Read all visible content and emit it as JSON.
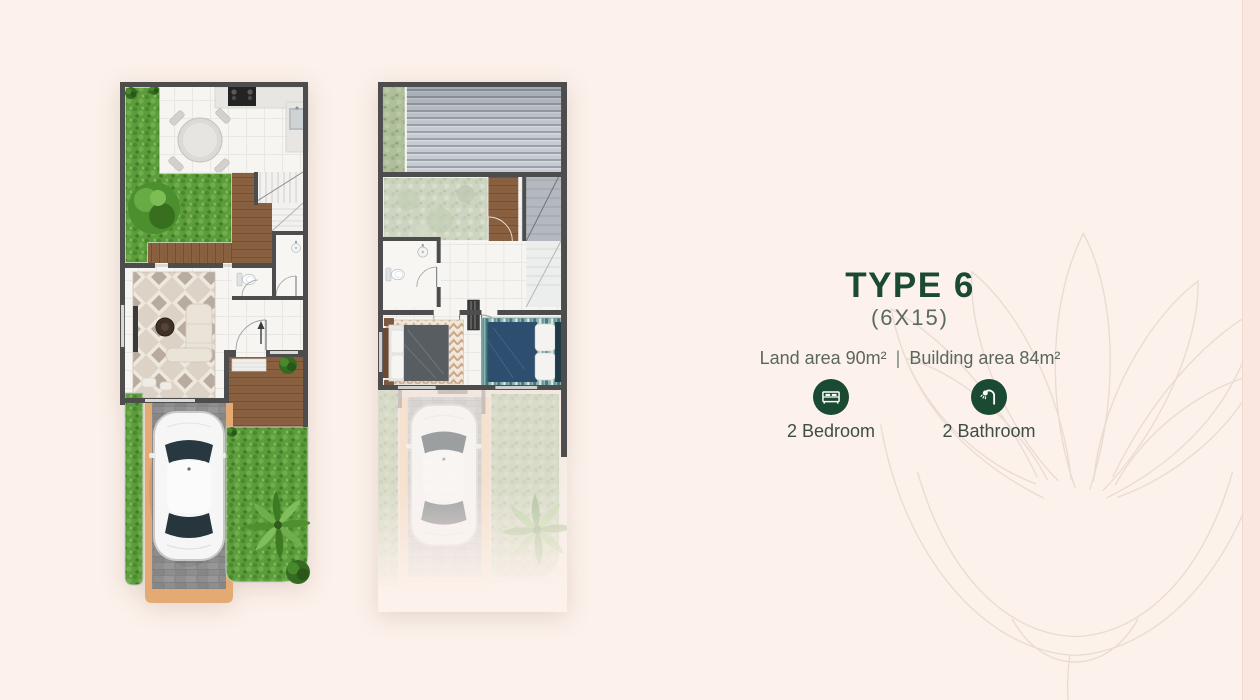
{
  "theme": {
    "bg": "#fcf1eb",
    "accent": "#1b4a33",
    "text_gray": "#5a665e",
    "label": "#3e4e45",
    "strip": "#f9e7e0",
    "strip_border": "#f0d8ce",
    "lotus": "#e9dcd1"
  },
  "info": {
    "title": "TYPE 6",
    "subtitle": "(6X15)",
    "land_area": "Land area 90m²",
    "divider": "|",
    "building_area": "Building area 84m²",
    "features": [
      {
        "icon": "bed-icon",
        "label": "2 Bedroom"
      },
      {
        "icon": "shower-icon",
        "label": "2 Bathroom"
      }
    ]
  }
}
